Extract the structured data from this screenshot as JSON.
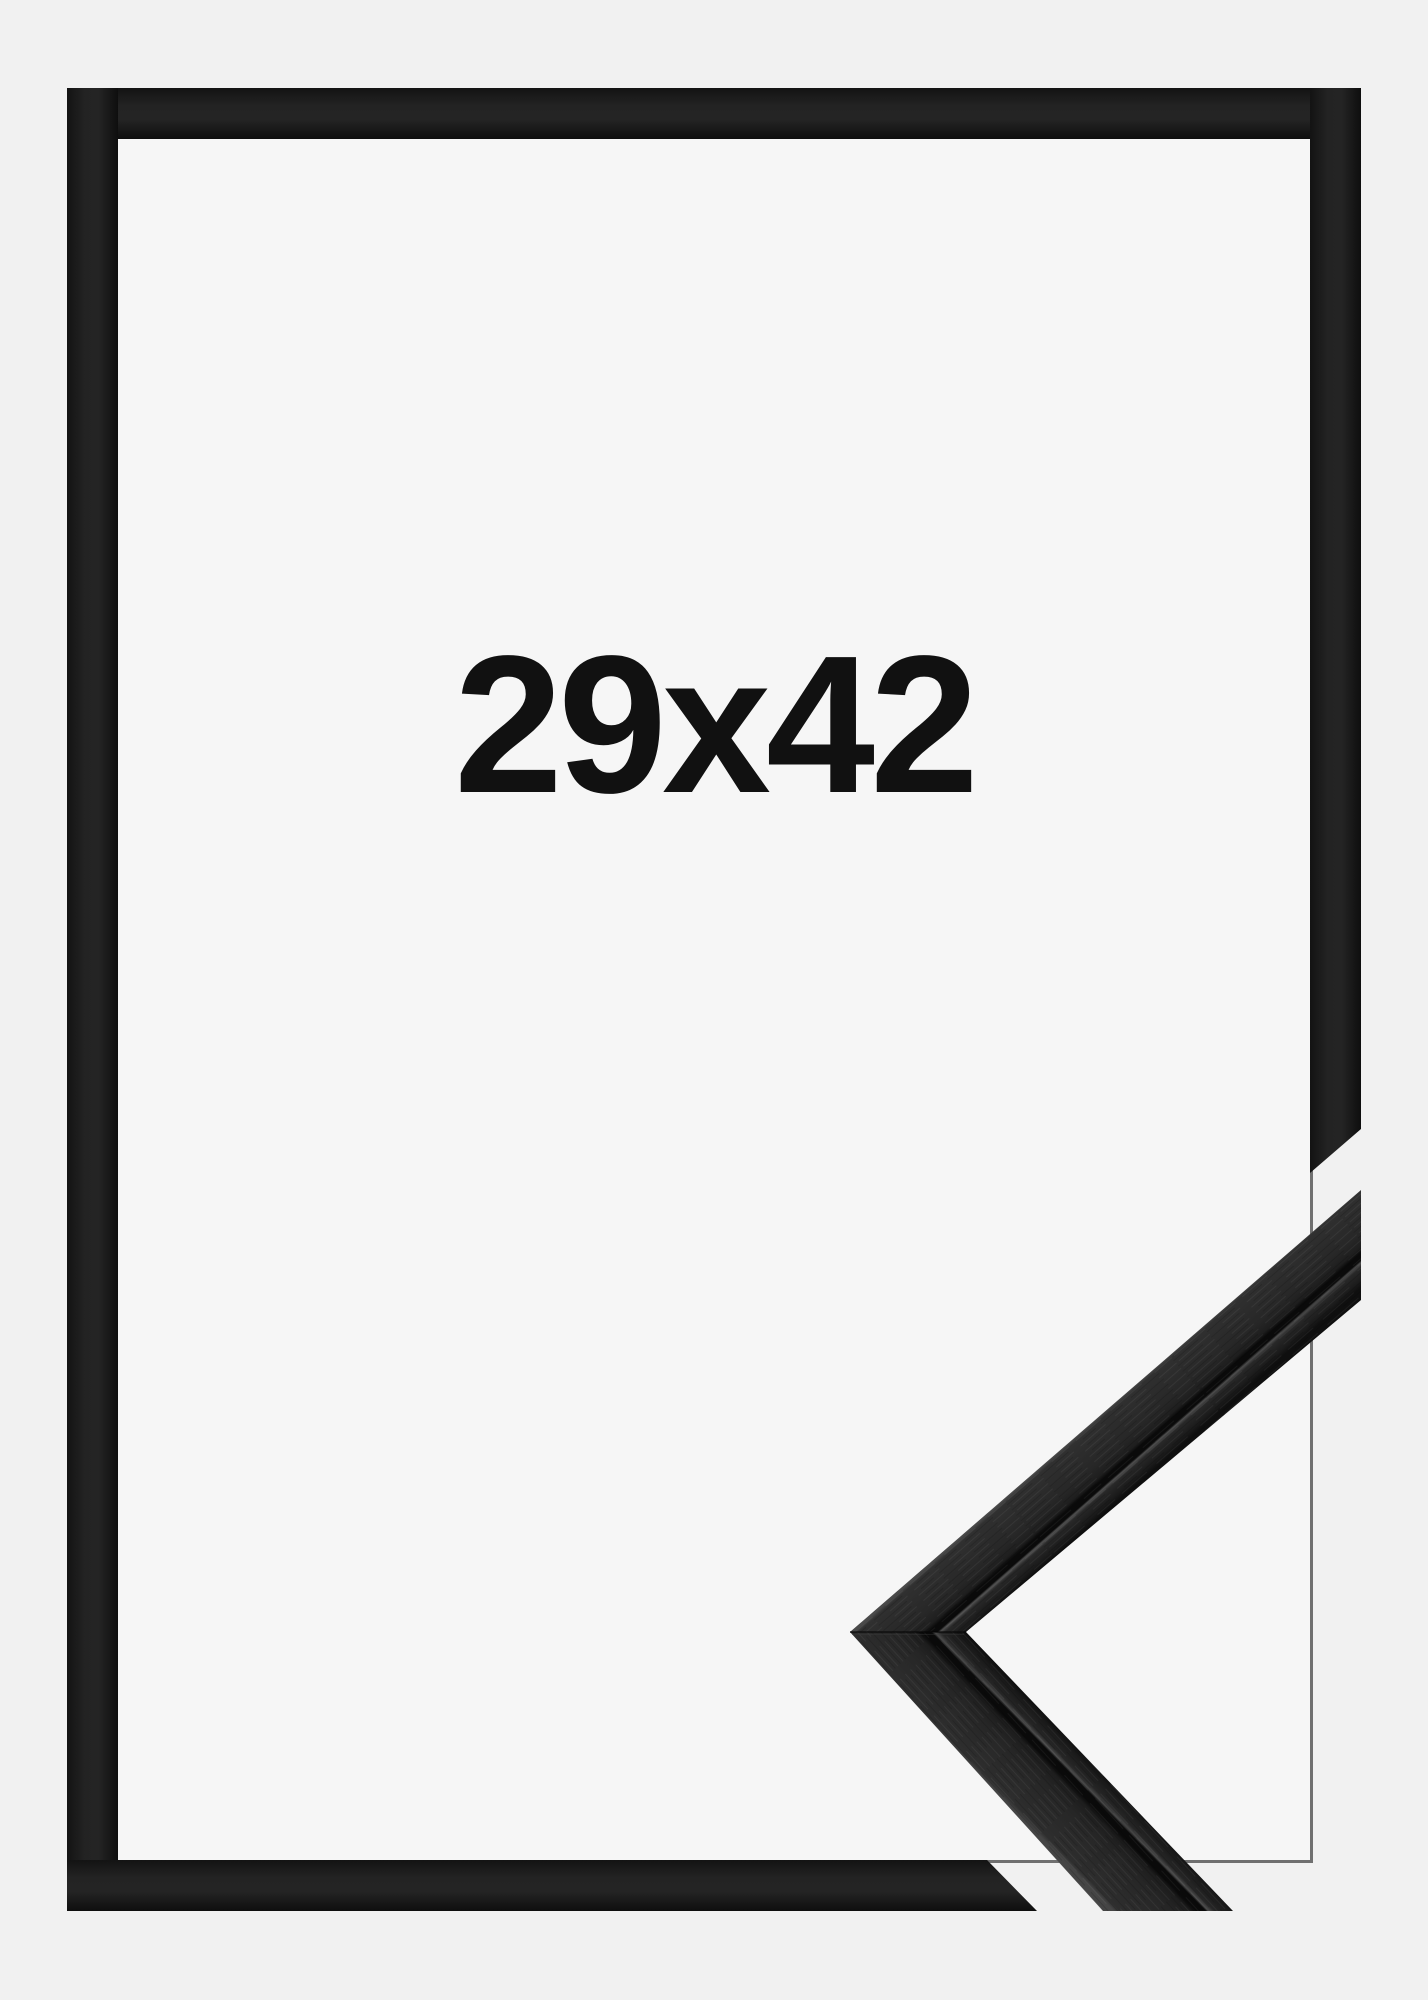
{
  "product": {
    "size_label": "29x42"
  },
  "colors": {
    "background_outer": "#f1f1f1",
    "background_inner": "#f6f6f6",
    "frame_black": "#1e1e1e",
    "closeup_face": "#272727",
    "closeup_groove": "#0a0a0a",
    "closeup_highlight": "#4e4e4e",
    "label_text": "#111111"
  },
  "graphics": {
    "frame_front_name": "frame-front-outline",
    "frame_front_desc": "flat black picture frame outline with mitre cut-away at lower right",
    "frame_profile_name": "frame-profile-closeup",
    "frame_profile_desc": "photographic close-up of black wood moulding corner joint"
  }
}
